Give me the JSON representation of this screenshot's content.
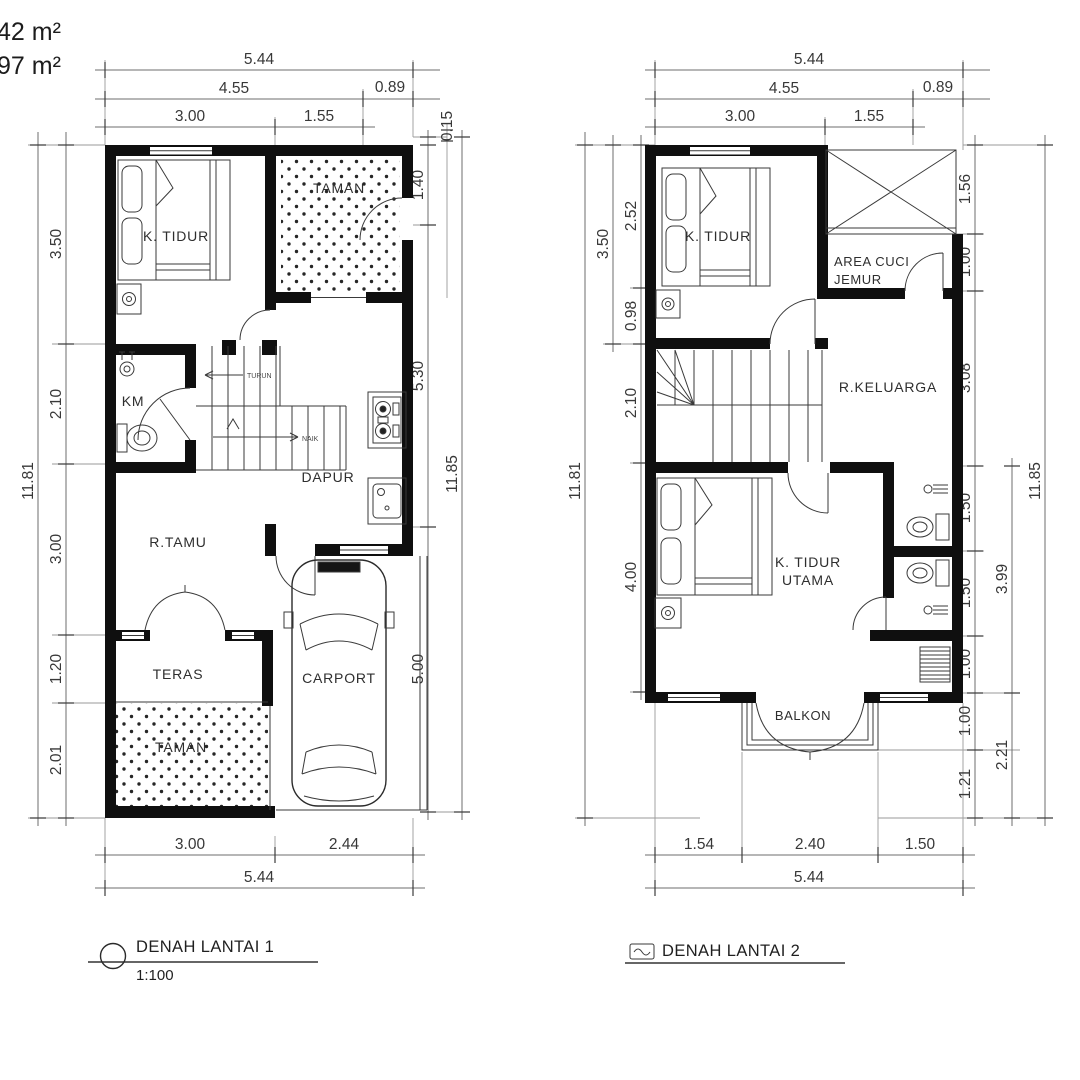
{
  "sheet": {
    "area_label_1": "42 m²",
    "area_label_2": "97 m²"
  },
  "colors": {
    "wall": "#0f0f0f",
    "thin_line": "#2b2b2b",
    "dimension_line": "#6e6e6e",
    "text": "#383838",
    "background": "#ffffff"
  },
  "plan1": {
    "title": "DENAH LANTAI 1",
    "scale": "1:100",
    "rooms": {
      "bedroom": "K. TIDUR",
      "garden_top": "TAMAN",
      "bathroom": "KM",
      "kitchen": "DAPUR",
      "living": "R.TAMU",
      "terrace": "TERAS",
      "garden_bottom": "TAMAN",
      "carport": "CARPORT",
      "stair_down": "TURUN",
      "stair_up": "NAIK"
    },
    "dims": {
      "top_total": "5.44",
      "top_a": "4.55",
      "top_b": "0.89",
      "top_c": "3.00",
      "top_d": "1.55",
      "top_e": "0.15",
      "left_total": "11.81",
      "left_1": "3.50",
      "left_2": "2.10",
      "left_3": "3.00",
      "left_4": "1.20",
      "left_5": "2.01",
      "right_1": "1.40",
      "right_2": "5.30",
      "right_3": "5.00",
      "right_total": "11.85",
      "bottom_a": "3.00",
      "bottom_b": "2.44",
      "bottom_total": "5.44"
    }
  },
  "plan2": {
    "title": "DENAH LANTAI 2",
    "rooms": {
      "bedroom": "K. TIDUR",
      "laundry_1": "AREA CUCI",
      "laundry_2": "JEMUR",
      "family": "R.KELUARGA",
      "master_1": "K. TIDUR",
      "master_2": "UTAMA",
      "balcony": "BALKON"
    },
    "dims": {
      "top_total": "5.44",
      "top_a": "4.55",
      "top_b": "0.89",
      "top_c": "3.00",
      "top_d": "1.55",
      "left_total": "11.81",
      "left_a": "3.50",
      "left_1": "2.52",
      "left_2": "0.98",
      "left_3": "2.10",
      "left_4": "4.00",
      "right_1": "1.56",
      "right_2": "1.00",
      "right_3": "3.08",
      "right_4": "1.50",
      "right_5": "1.50",
      "right_6": "1.00",
      "right_7": "1.00",
      "right_8": "1.21",
      "right_a": "3.99",
      "right_b": "2.21",
      "right_total": "11.85",
      "bottom_a": "1.54",
      "bottom_b": "2.40",
      "bottom_c": "1.50",
      "bottom_total": "5.44"
    }
  }
}
